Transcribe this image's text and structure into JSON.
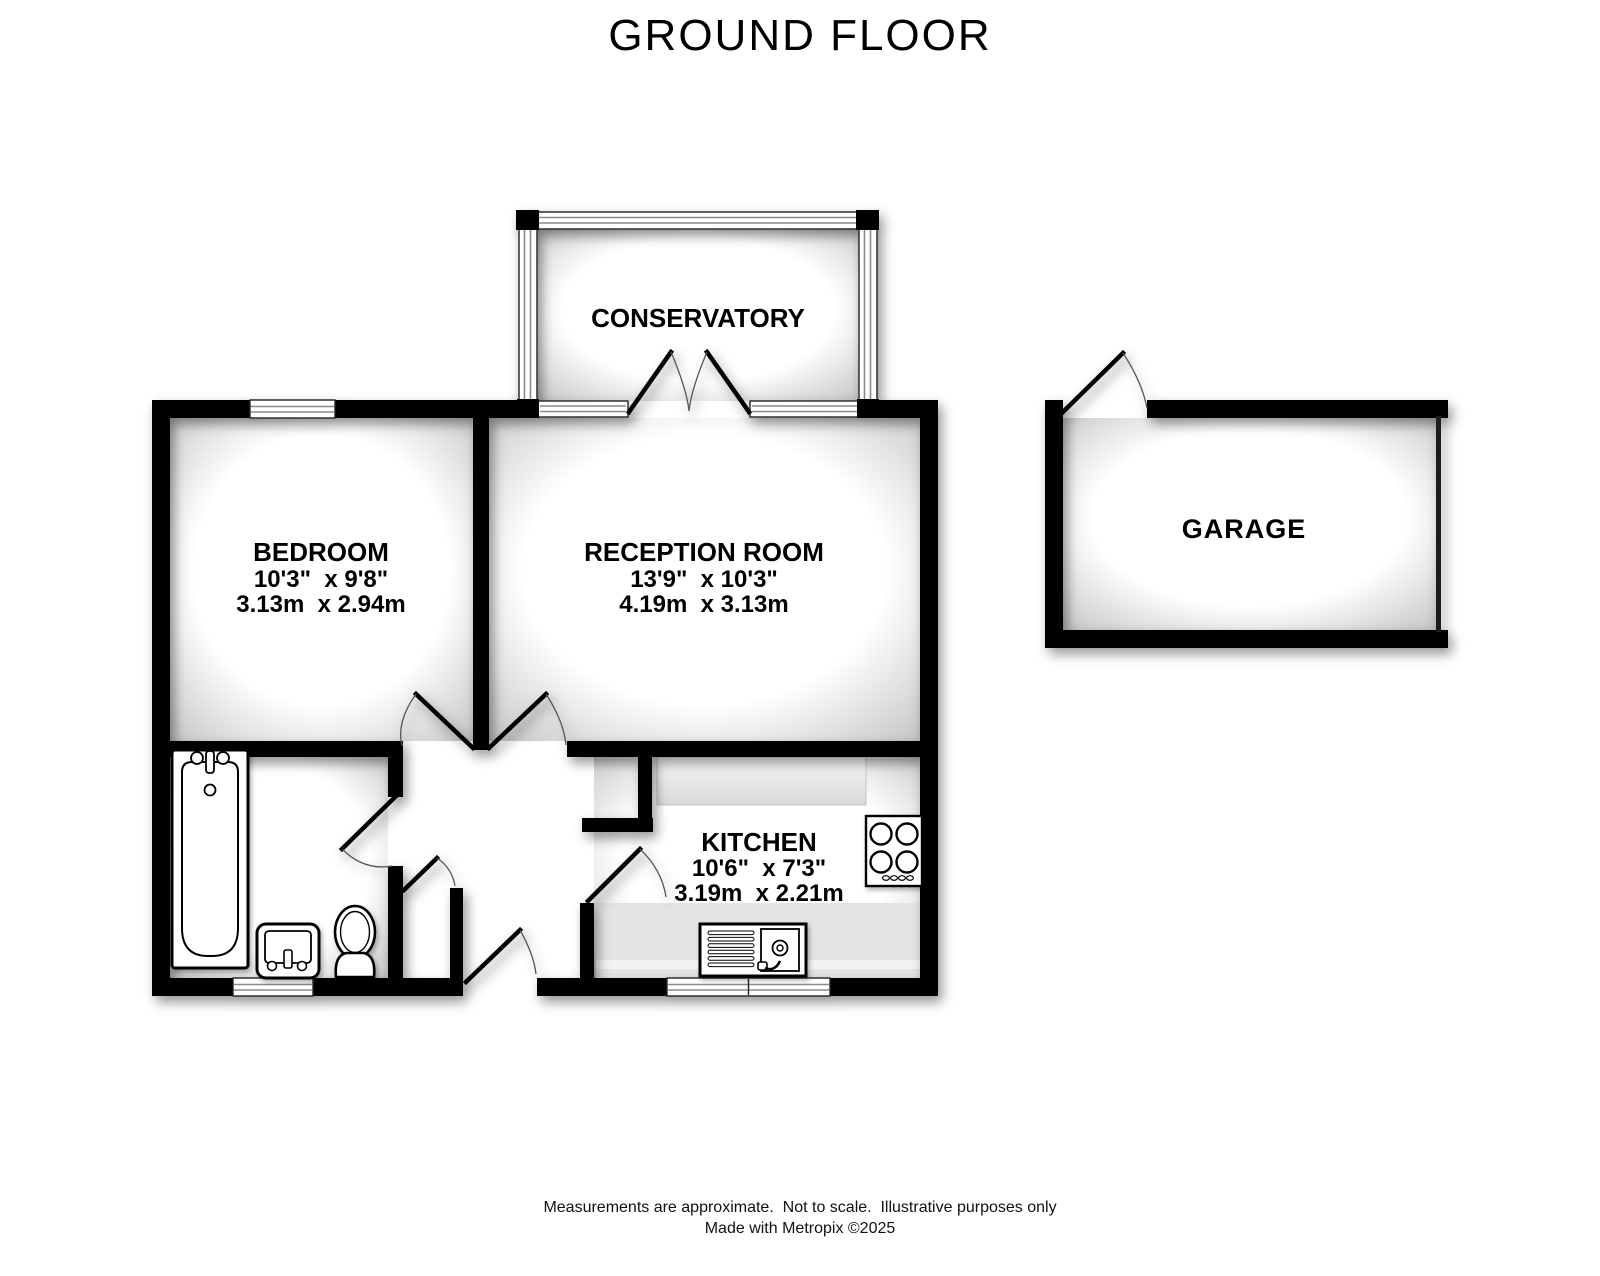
{
  "title": "GROUND FLOOR",
  "rooms": {
    "conservatory": {
      "name": "CONSERVATORY"
    },
    "bedroom": {
      "name": "BEDROOM",
      "imperial": "10'3\"  x 9'8\"",
      "metric": "3.13m  x 2.94m"
    },
    "reception": {
      "name": "RECEPTION ROOM",
      "imperial": "13'9\"  x 10'3\"",
      "metric": "4.19m  x 3.13m"
    },
    "kitchen": {
      "name": "KITCHEN",
      "imperial": "10'6\"  x 7'3\"",
      "metric": "3.19m  x 2.21m"
    },
    "garage": {
      "name": "GARAGE"
    }
  },
  "footer": {
    "line1": "Measurements are approximate.  Not to scale.  Illustrative purposes only",
    "line2": "Made with Metropix ©2025"
  },
  "colors": {
    "wall": "#000000",
    "floor": "#ffffff",
    "room_shade_edge": "#c6c6c6",
    "counter": "#e6e6e6",
    "door_swing": "#555555"
  }
}
